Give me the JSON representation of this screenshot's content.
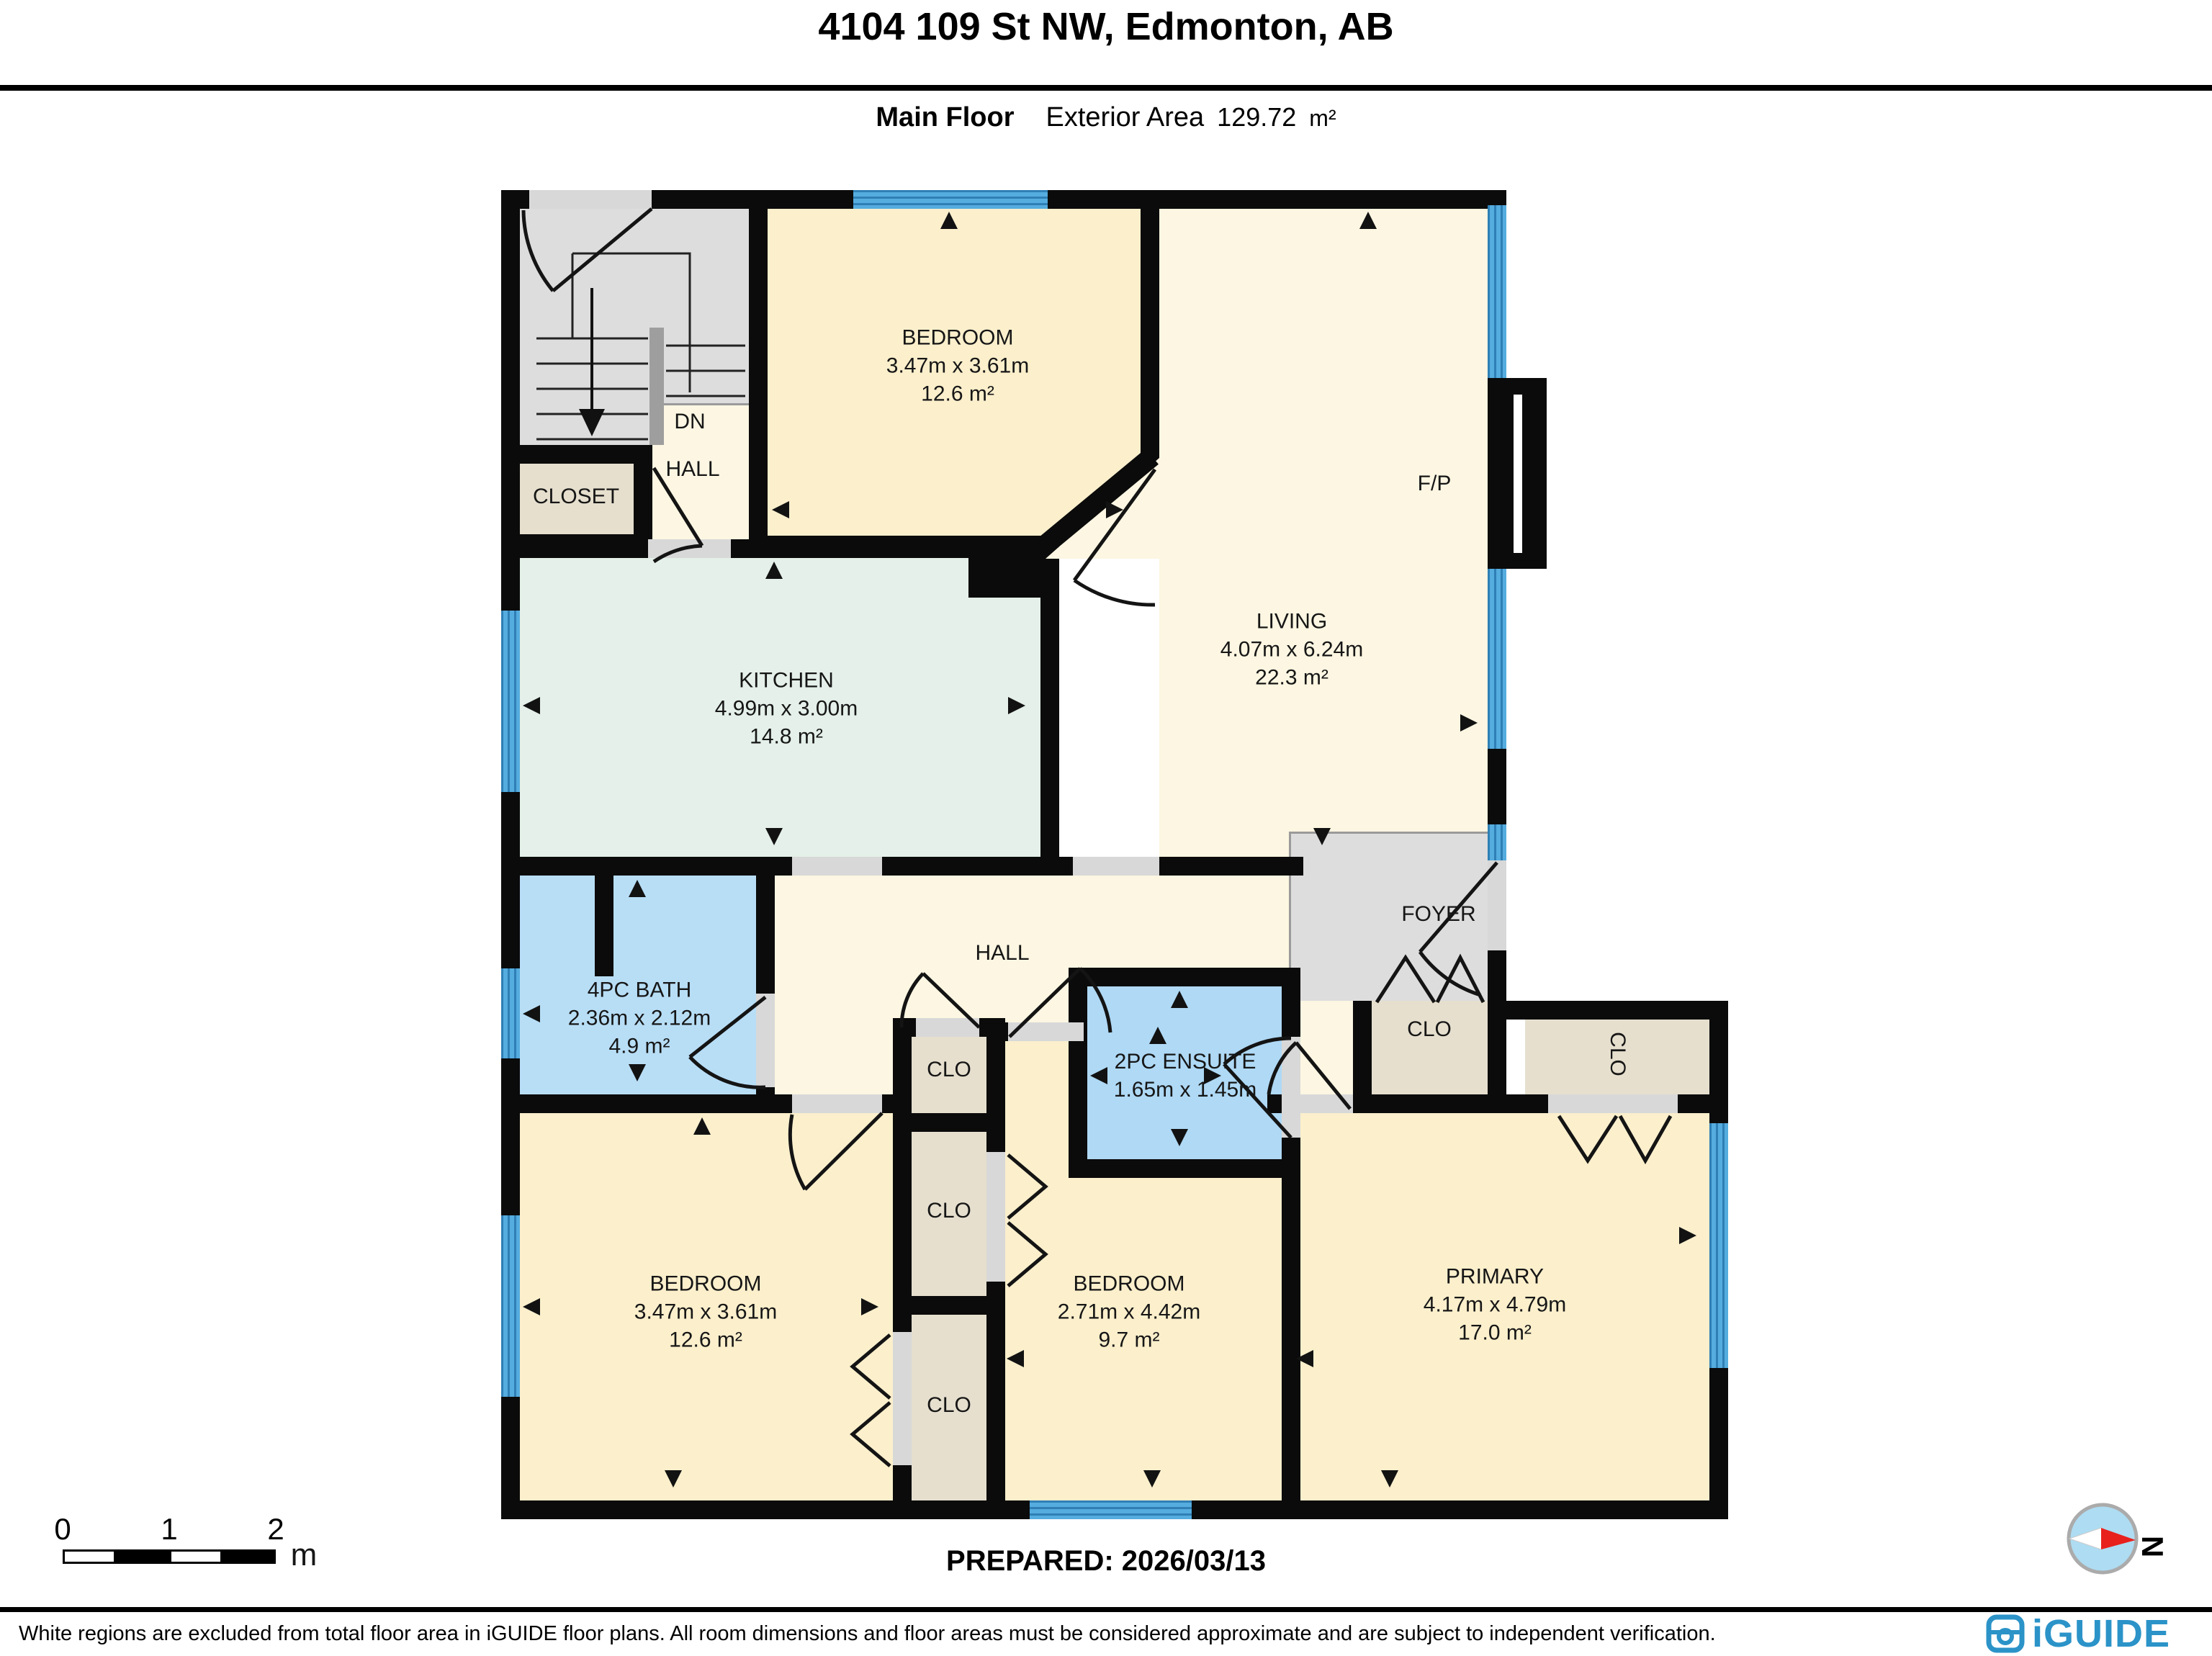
{
  "header": {
    "title": "4104 109 St NW, Edmonton, AB",
    "floor_label": "Main Floor",
    "area_label": "Exterior Area",
    "area_value": "129.72",
    "area_unit": "m²"
  },
  "rooms": {
    "bedroom_top": {
      "name": "BEDROOM",
      "dims": "3.47m x 3.61m",
      "area": "12.6 m²"
    },
    "living": {
      "name": "LIVING",
      "dims": "4.07m x 6.24m",
      "area": "22.3 m²"
    },
    "kitchen": {
      "name": "KITCHEN",
      "dims": "4.99m x 3.00m",
      "area": "14.8 m²"
    },
    "bath": {
      "name": "4PC BATH",
      "dims": "2.36m x 2.12m",
      "area": "4.9 m²"
    },
    "ensuite": {
      "name": "2PC ENSUITE",
      "dims": "1.65m x 1.45m"
    },
    "bedroom_left": {
      "name": "BEDROOM",
      "dims": "3.47m x 3.61m",
      "area": "12.6 m²"
    },
    "bedroom_middle": {
      "name": "BEDROOM",
      "dims": "2.71m x 4.42m",
      "area": "9.7 m²"
    },
    "primary": {
      "name": "PRIMARY",
      "dims": "4.17m x 4.79m",
      "area": "17.0 m²"
    },
    "foyer": "FOYER",
    "hall": "HALL",
    "hall_upper": "HALL",
    "closet": "CLOSET",
    "clo": "CLO",
    "dn": "DN",
    "fireplace": "F/P"
  },
  "scale_bar": {
    "t0": "0",
    "t1": "1",
    "t2": "2",
    "unit": "m"
  },
  "prepared": "PREPARED: 2026/03/13",
  "compass": {
    "label": "N"
  },
  "footer": {
    "disclaimer": "White regions are excluded from total floor area in iGUIDE floor plans. All room dimensions and floor areas must be considered approximate and are subject to independent verification.",
    "brand": "iGUIDE"
  },
  "colors": {
    "wall": "#0b0b0b",
    "window_blue": "#55acde",
    "room_cream": "#fbefcc",
    "hall_cream": "#fcf6e2",
    "kitchen_mint": "#e4f0e9",
    "bath_blue": "#b8def6",
    "ensuite_blue": "#afd9f5",
    "closet_beige": "#e6dfce",
    "gray": "#dddddd",
    "brand_blue": "#2b93c8",
    "compass_red": "#e8211d"
  }
}
